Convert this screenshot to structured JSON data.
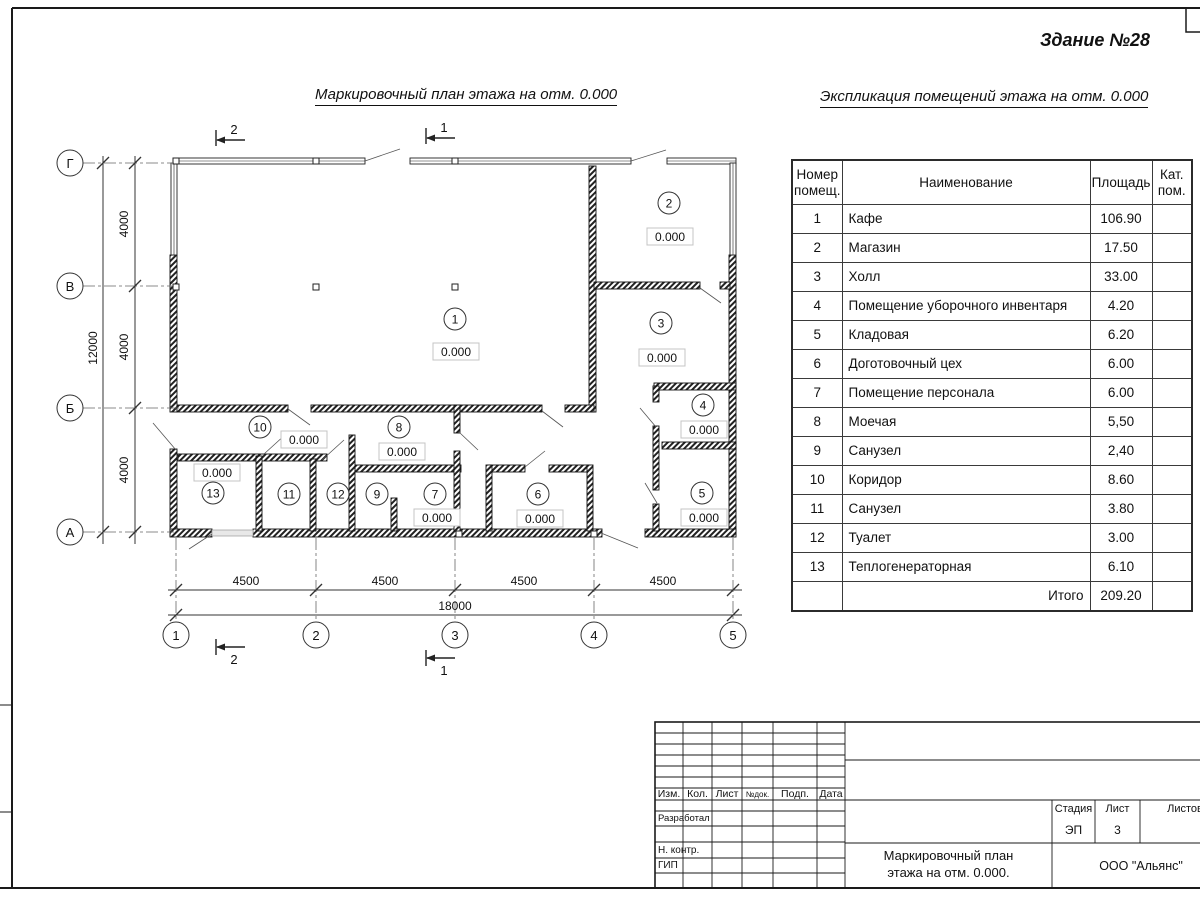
{
  "sheet": {
    "building_title": "Здание №28",
    "plan_title": "Маркировочный план этажа на отм. 0.000",
    "explication_title": "Экспликация помещений этажа на отм. 0.000"
  },
  "plan": {
    "axes_left": [
      "Г",
      "В",
      "Б",
      "А"
    ],
    "axes_bottom": [
      "1",
      "2",
      "3",
      "4",
      "5"
    ],
    "dims_left": [
      "4000",
      "4000",
      "4000"
    ],
    "dim_left_total": "12000",
    "dims_bottom": [
      "4500",
      "4500",
      "4500",
      "4500"
    ],
    "dim_bottom_total": "18000",
    "section_cut_1": "1",
    "section_cut_2": "2",
    "rooms": [
      {
        "number": "1",
        "elevation": "0.000"
      },
      {
        "number": "2",
        "elevation": "0.000"
      },
      {
        "number": "3",
        "elevation": "0.000"
      },
      {
        "number": "4",
        "elevation": "0.000"
      },
      {
        "number": "5",
        "elevation": "0.000"
      },
      {
        "number": "6",
        "elevation": "0.000"
      },
      {
        "number": "7",
        "elevation": "0.000"
      },
      {
        "number": "8",
        "elevation": "0.000"
      },
      {
        "number": "9"
      },
      {
        "number": "10",
        "elevation": "0.000"
      },
      {
        "number": "11"
      },
      {
        "number": "12"
      },
      {
        "number": "13",
        "elevation": "0.000"
      }
    ]
  },
  "table": {
    "headers": {
      "num": "Номер помещ.",
      "name": "Наименование",
      "area": "Площадь",
      "cat": "Кат. пом."
    },
    "rows": [
      {
        "n": "1",
        "name": "Кафе",
        "area": "106.90",
        "cat": ""
      },
      {
        "n": "2",
        "name": "Магазин",
        "area": "17.50",
        "cat": ""
      },
      {
        "n": "3",
        "name": "Холл",
        "area": "33.00",
        "cat": ""
      },
      {
        "n": "4",
        "name": "Помещение уборочного инвентаря",
        "area": "4.20",
        "cat": ""
      },
      {
        "n": "5",
        "name": "Кладовая",
        "area": "6.20",
        "cat": ""
      },
      {
        "n": "6",
        "name": "Доготовочный цех",
        "area": "6.00",
        "cat": ""
      },
      {
        "n": "7",
        "name": "Помещение персонала",
        "area": "6.00",
        "cat": ""
      },
      {
        "n": "8",
        "name": "Моечая",
        "area": "5,50",
        "cat": ""
      },
      {
        "n": "9",
        "name": "Санузел",
        "area": "2,40",
        "cat": ""
      },
      {
        "n": "10",
        "name": "Коридор",
        "area": "8.60",
        "cat": ""
      },
      {
        "n": "11",
        "name": "Санузел",
        "area": "3.80",
        "cat": ""
      },
      {
        "n": "12",
        "name": "Туалет",
        "area": "3.00",
        "cat": ""
      },
      {
        "n": "13",
        "name": "Теплогенераторная",
        "area": "6.10",
        "cat": ""
      }
    ],
    "total_label": "Итого",
    "total_value": "209.20"
  },
  "title_block": {
    "cols": {
      "izm": "Изм.",
      "kol": "Кол.",
      "list": "Лист",
      "ndok": "№док.",
      "podp": "Подп.",
      "data": "Дата"
    },
    "rows": {
      "developed": "Разработал",
      "ncontr": "Н. контр.",
      "gip": "ГИП"
    },
    "stage_label": "Стадия",
    "sheet_label": "Лист",
    "sheets_label": "Листов",
    "stage_value": "ЭП",
    "sheet_value": "3",
    "doc_title_line1": "Маркировочный план",
    "doc_title_line2": "этажа на отм. 0.000.",
    "company": "ООО \"Альянс\""
  }
}
